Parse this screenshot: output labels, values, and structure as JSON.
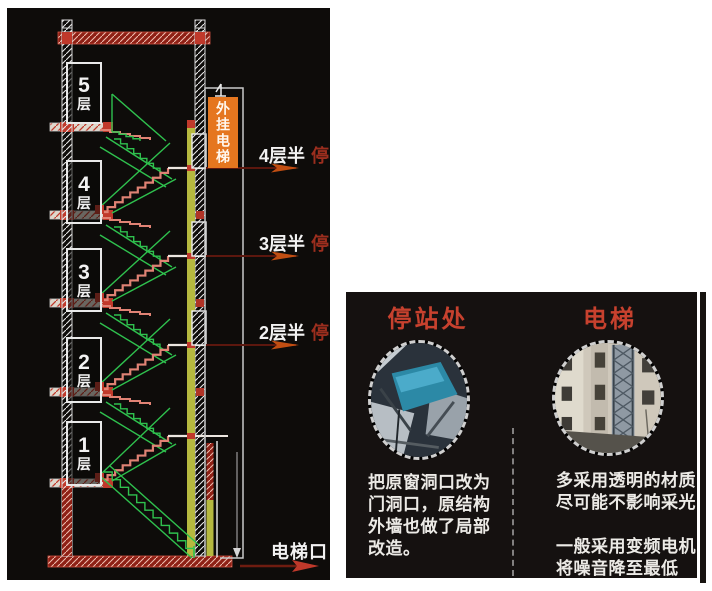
{
  "section_diagram": {
    "floors": [
      {
        "num": "5",
        "suffix": "层"
      },
      {
        "num": "4",
        "suffix": "层"
      },
      {
        "num": "3",
        "suffix": "层"
      },
      {
        "num": "2",
        "suffix": "层"
      },
      {
        "num": "1",
        "suffix": "层"
      }
    ],
    "elevator_tag": "外挂电梯",
    "stops": [
      {
        "level": "4层半",
        "mark": "停"
      },
      {
        "level": "3层半",
        "mark": "停"
      },
      {
        "level": "2层半",
        "mark": "停"
      }
    ],
    "entrance": "电梯口"
  },
  "info_panel": {
    "columns": [
      {
        "title": "停站处",
        "photo": "station-photo",
        "caption": "把原窗洞口改为\n门洞口，原结构\n外墙也做了局部\n改造。"
      },
      {
        "title": "电梯",
        "photo": "elevator-photo",
        "caption": "多采用透明的材质\n尽可能不影响采光\n\n一般采用变频电机\n将噪音降至最低"
      }
    ]
  },
  "colors": {
    "panel_black": "#0e0c0a",
    "cad_green": "#2fc14e",
    "stair_pink": "#e08274",
    "hatch_red": "#8e2015",
    "accent_red": "#c0392b",
    "rail_yellow": "#b6b93f",
    "tag_orange": "#e5761f",
    "header_red": "#c7412e",
    "stop_mark_red": "#9c2e1e",
    "arrow_orange": "#c14e12",
    "text_white": "#f2f2f2"
  }
}
